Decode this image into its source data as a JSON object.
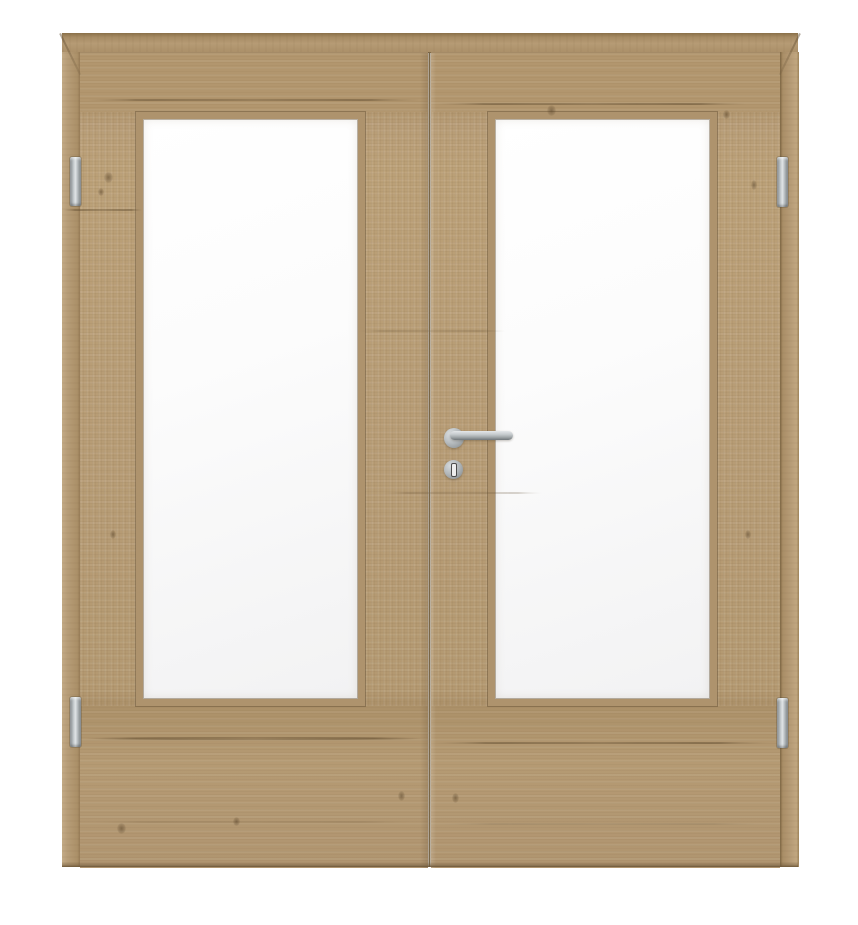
{
  "meta": {
    "type": "product-photo",
    "subject": "Double interior door in light oak with full-height frosted glass panel in each leaf, on plain white background"
  },
  "door_unit": {
    "frame": {
      "parts": [
        "head",
        "left-jamb",
        "right-jamb"
      ],
      "corner_joints": "mitered"
    },
    "leaves": [
      {
        "side": "left",
        "glass_panel": "frosted",
        "grain": "horizontal rails, vertical stiles"
      },
      {
        "side": "right",
        "glass_panel": "frosted",
        "grain": "horizontal rails, vertical stiles"
      }
    ],
    "center_gap": "vertical seam between the two leaves",
    "hinges": [
      {
        "position": "top-left"
      },
      {
        "position": "bottom-left"
      },
      {
        "position": "top-right"
      },
      {
        "position": "bottom-right"
      }
    ],
    "handle": {
      "type": "straight stainless lever on round rosette",
      "location": "inner stile of right leaf, pointing right"
    },
    "keyhole": {
      "type": "round rosette with vertical key slot",
      "location": "below lever handle"
    }
  },
  "colors": {
    "background": "#ffffff",
    "wood_base": "#b59a74",
    "wood_light": "#c3ab86",
    "wood_dark": "#967b57",
    "wood_crack": "#5c482c",
    "bead": "#ae936d",
    "gap": "#6f5c40",
    "glass": "#f2f2f3",
    "glass_highlight": "#ffffff",
    "metal_base": "#9aa0a3",
    "metal_light": "#dde1e3",
    "metal_dark": "#6f7578"
  }
}
